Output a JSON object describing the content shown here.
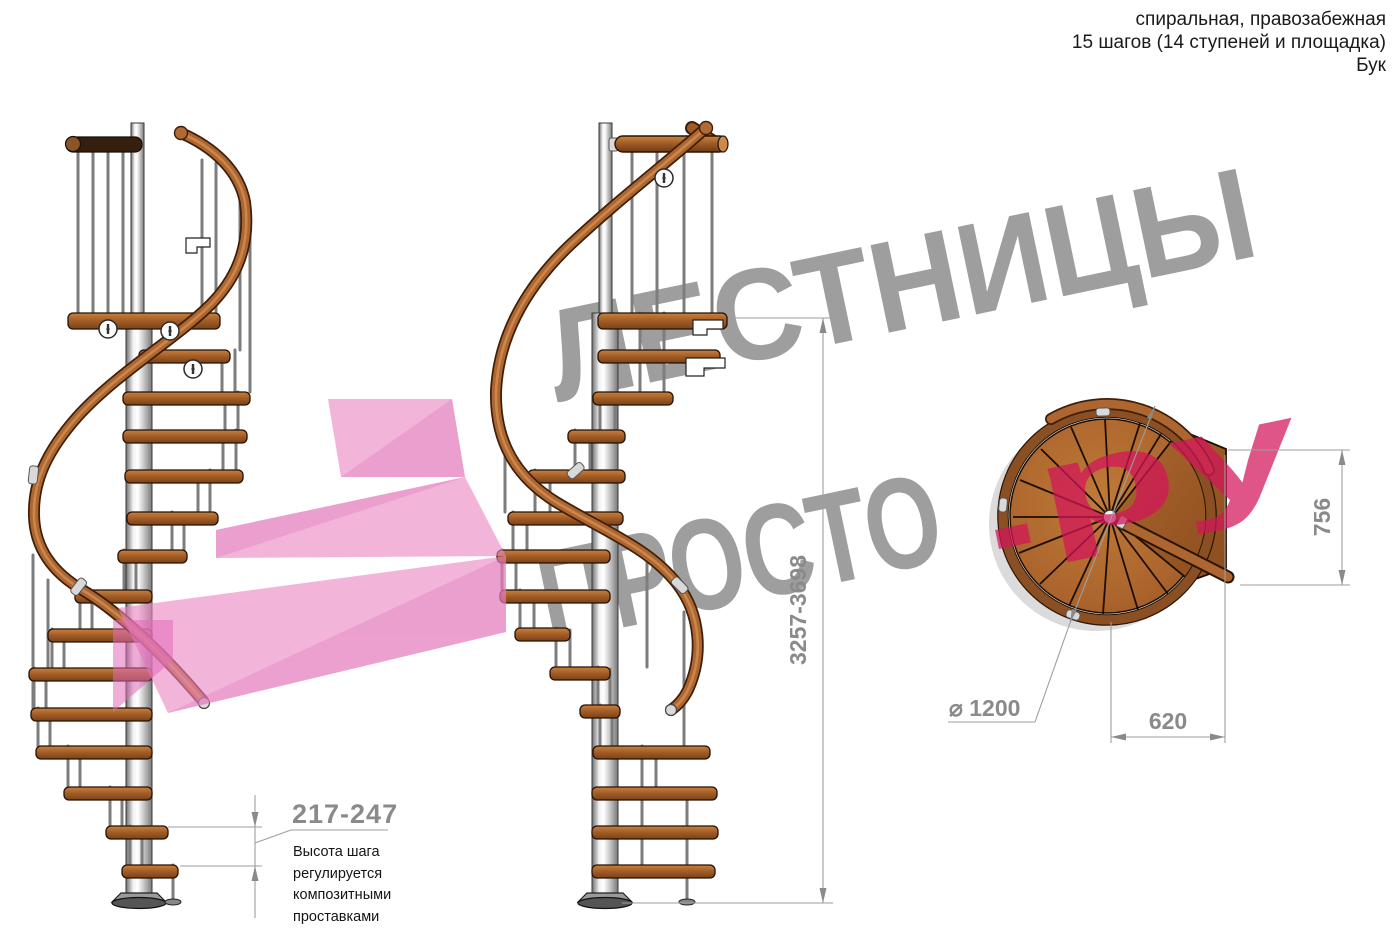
{
  "header": {
    "line1": "спиральная, правозабежная",
    "line2": "15 шагов (14 ступеней и площадка)",
    "line3": "Бук"
  },
  "watermark": {
    "word1": "ЛЕСТНИЦЫ",
    "word2": "ПРОСТО",
    "word2_suffix": ".ру",
    "gray": "#9d9d9d",
    "pink": "#e2567c",
    "arrow_pink": "#f3b3d7"
  },
  "dimensions": {
    "total_height": "3257-3698",
    "landing_depth": "756",
    "landing_width": "620",
    "diameter": "⌀ 1200",
    "step_height": "217-247",
    "note": [
      "Высота шага",
      "регулируется",
      "композитными",
      "проставками"
    ]
  },
  "colors": {
    "wood": "#a9602a",
    "wood_dark": "#6e3a14",
    "metal_pole": "#c9c9c9",
    "dim_gray": "#8a8a8a",
    "dark_rail": "#35200f"
  }
}
